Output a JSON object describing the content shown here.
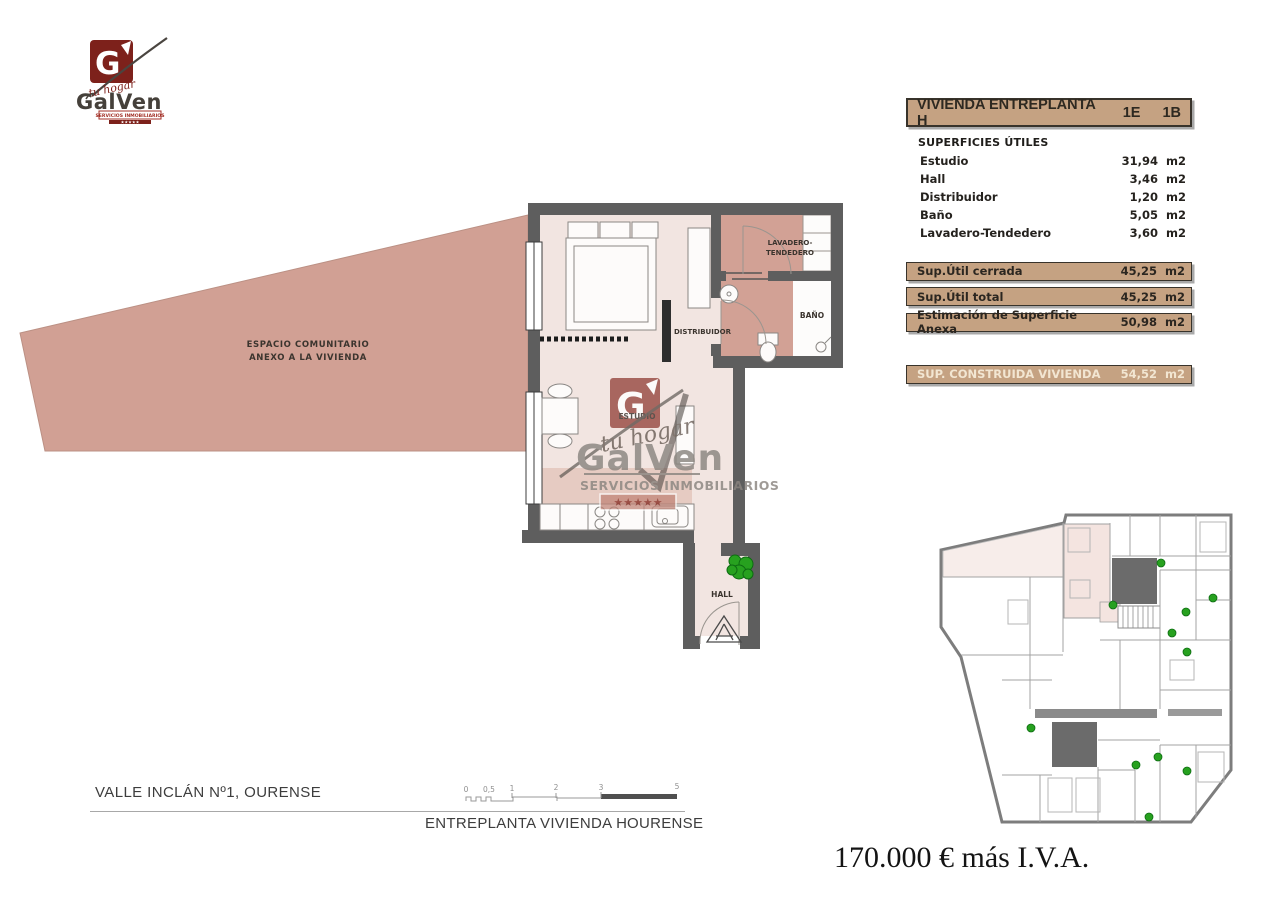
{
  "logo": {
    "brand": "GalVen",
    "tagline": "tu hogar",
    "subtitle": "SERVICIOS INMOBILIARIOS",
    "stars": "★★★★★"
  },
  "panel": {
    "title": "VIVIENDA ENTREPLANTA H",
    "code_e": "1E",
    "code_b": "1B",
    "section_title": "SUPERFICIES ÚTILES",
    "rooms": [
      {
        "label": "Estudio",
        "value": "31,94",
        "unit": "m2"
      },
      {
        "label": "Hall",
        "value": "3,46",
        "unit": "m2"
      },
      {
        "label": "Distribuidor",
        "value": "1,20",
        "unit": "m2"
      },
      {
        "label": "Baño",
        "value": "5,05",
        "unit": "m2"
      },
      {
        "label": "Lavadero-Tendedero",
        "value": "3,60",
        "unit": "m2"
      }
    ],
    "totals": [
      {
        "label": "Sup.Útil cerrada",
        "value": "45,25",
        "unit": "m2"
      },
      {
        "label": "Sup.Útil total",
        "value": "45,25",
        "unit": "m2"
      },
      {
        "label": "Estimación de Superficie Anexa",
        "value": "50,98",
        "unit": "m2"
      }
    ],
    "built": {
      "label": "SUP. CONSTRUIDA VIVIENDA",
      "value": "54,52",
      "unit": "m2"
    }
  },
  "plan": {
    "espacio_line1": "ESPACIO COMUNITARIO",
    "espacio_line2": "ANEXO A LA VIVIENDA",
    "estudio": "ESTUDIO",
    "distribuidor": "DISTRIBUIDOR",
    "lavadero_line1": "LAVADERO-",
    "lavadero_line2": "TENDEDERO",
    "bano": "BAÑO",
    "hall": "HALL",
    "watermark_brand": "GalVen",
    "watermark_tagline": "tu hogar",
    "watermark_subtitle": "SERVICIOS INMOBILIARIOS",
    "watermark_stars": "★★★★★"
  },
  "footer": {
    "address": "VALLE INCLÁN Nº1, OURENSE",
    "scale_ticks": [
      "0",
      "0,5",
      "1",
      "2",
      "3",
      "5"
    ],
    "plan_title": "ENTREPLANTA VIVIENDA H",
    "city": "OURENSE",
    "price": "170.000 € más I.V.A."
  },
  "colors": {
    "tan": "#c5a282",
    "salmon": "#d2a195",
    "floor_pink": "#f2e5e1",
    "wall_gray": "#5e5e5e",
    "brand_red": "#7d211b",
    "plant_green": "#27a11f"
  }
}
